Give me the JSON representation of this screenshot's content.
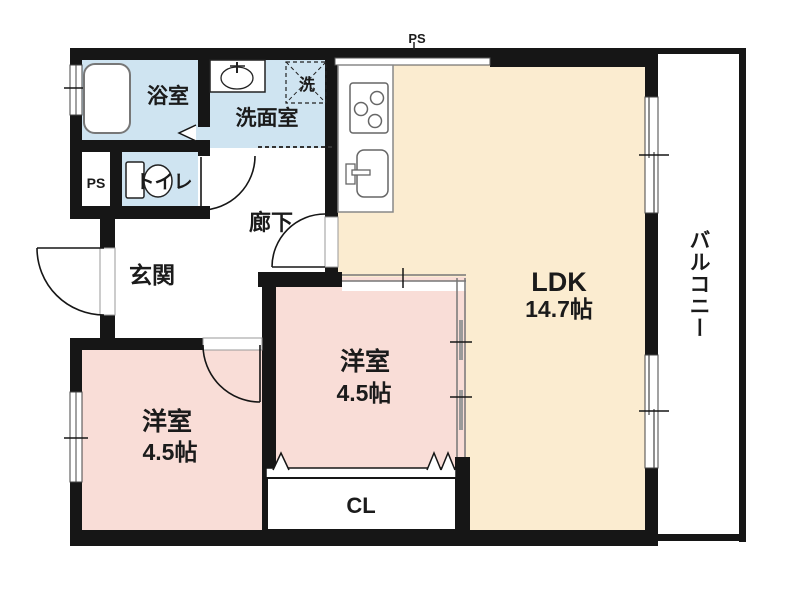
{
  "floorplan": {
    "type": "japanese-apartment-floorplan",
    "rooms": {
      "bathroom": {
        "label": "浴室"
      },
      "washroom": {
        "label": "洗面室"
      },
      "laundry": {
        "label": "洗"
      },
      "toilet": {
        "label": "トイレ"
      },
      "pipe_space_closet": {
        "label": "PS"
      },
      "pipe_space_top": {
        "label": "PS"
      },
      "corridor": {
        "label": "廊下"
      },
      "entrance": {
        "label": "玄関"
      },
      "ldk": {
        "label": "LDK",
        "size": "14.7帖"
      },
      "bedroom_center": {
        "label": "洋室",
        "size": "4.5帖"
      },
      "bedroom_left": {
        "label": "洋室",
        "size": "4.5帖"
      },
      "closet": {
        "label": "CL"
      },
      "balcony": {
        "label": "バルコニー"
      }
    },
    "colors": {
      "wall": "#161616",
      "wet_area_blue": "#cfe4f1",
      "bedroom_pink": "#f9ddd7",
      "ldk_cream": "#fbecd0",
      "background": "#ffffff"
    }
  }
}
